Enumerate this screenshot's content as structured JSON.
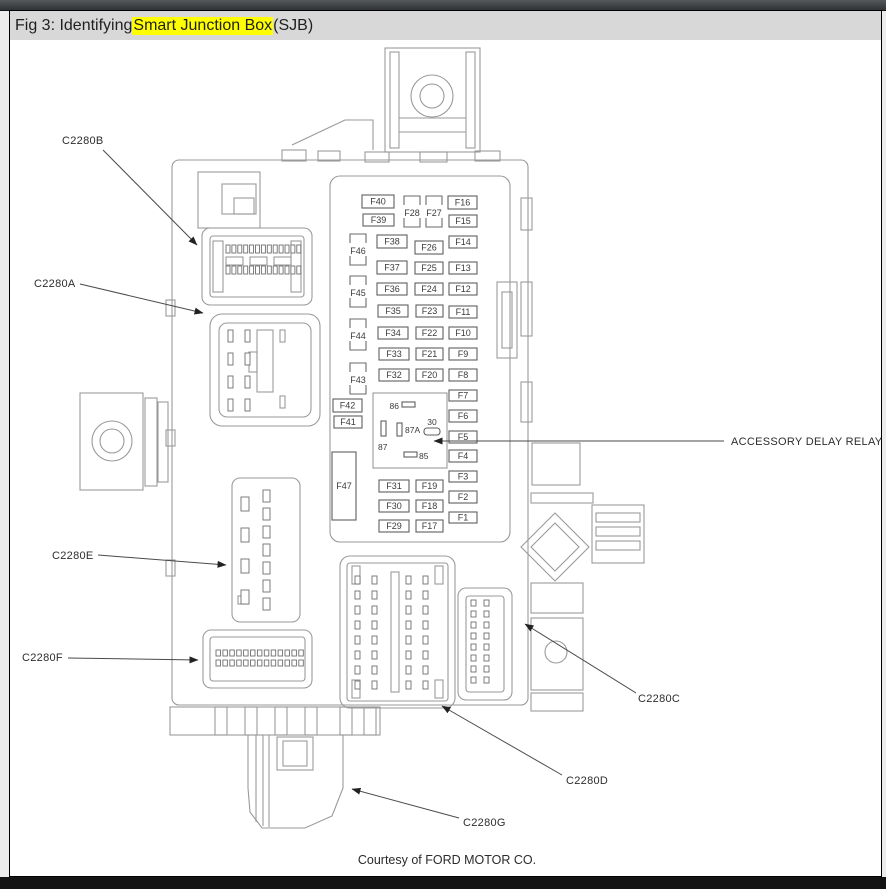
{
  "window": {
    "title_prefix": "Fig 3: Identifying ",
    "title_highlight": "Smart Junction Box",
    "title_suffix": " (SJB)",
    "highlight_color": "#ffff00"
  },
  "footer": {
    "courtesy": "Courtesy of FORD MOTOR CO."
  },
  "diagram": {
    "subject": "Smart Junction Box (SJB) fuse panel",
    "callouts": [
      {
        "id": "c2280b",
        "text": "C2280B",
        "tx": 62,
        "ty": 144,
        "x1": 103,
        "y1": 150,
        "x2": 197,
        "y2": 245
      },
      {
        "id": "c2280a",
        "text": "C2280A",
        "tx": 34,
        "ty": 287,
        "x1": 80,
        "y1": 284,
        "x2": 203,
        "y2": 313
      },
      {
        "id": "c2280e",
        "text": "C2280E",
        "tx": 52,
        "ty": 559,
        "x1": 98,
        "y1": 555,
        "x2": 226,
        "y2": 565
      },
      {
        "id": "c2280f",
        "text": "C2280F",
        "tx": 22,
        "ty": 661,
        "x1": 68,
        "y1": 658,
        "x2": 198,
        "y2": 660
      },
      {
        "id": "c2280c",
        "text": "C2280C",
        "tx": 638,
        "ty": 702,
        "x1": 636,
        "y1": 693,
        "x2": 525,
        "y2": 624
      },
      {
        "id": "c2280d",
        "text": "C2280D",
        "tx": 566,
        "ty": 784,
        "x1": 562,
        "y1": 775,
        "x2": 442,
        "y2": 706
      },
      {
        "id": "c2280g",
        "text": "C2280G",
        "tx": 463,
        "ty": 826,
        "x1": 459,
        "y1": 818,
        "x2": 352,
        "y2": 789
      },
      {
        "id": "accessory-delay-relay",
        "text": "ACCESSORY DELAY RELAY",
        "tx": 731,
        "ty": 445,
        "x1": 724,
        "y1": 441,
        "x2": 434,
        "y2": 441
      }
    ],
    "fuses": [
      {
        "l": "F40",
        "x": 362,
        "y": 195,
        "w": 32,
        "h": 13
      },
      {
        "l": "F39",
        "x": 363,
        "y": 214,
        "w": 31,
        "h": 12
      },
      {
        "l": "F38",
        "x": 377,
        "y": 235,
        "w": 30,
        "h": 13
      },
      {
        "l": "F37",
        "x": 377,
        "y": 261,
        "w": 30,
        "h": 13
      },
      {
        "l": "F36",
        "x": 377,
        "y": 283,
        "w": 30,
        "h": 12
      },
      {
        "l": "F35",
        "x": 378,
        "y": 305,
        "w": 30,
        "h": 12
      },
      {
        "l": "F34",
        "x": 378,
        "y": 327,
        "w": 30,
        "h": 12
      },
      {
        "l": "F33",
        "x": 379,
        "y": 348,
        "w": 30,
        "h": 12
      },
      {
        "l": "F32",
        "x": 379,
        "y": 369,
        "w": 30,
        "h": 12
      },
      {
        "l": "F31",
        "x": 379,
        "y": 480,
        "w": 30,
        "h": 12
      },
      {
        "l": "F30",
        "x": 379,
        "y": 500,
        "w": 30,
        "h": 12
      },
      {
        "l": "F29",
        "x": 379,
        "y": 520,
        "w": 30,
        "h": 12
      },
      {
        "l": "F26",
        "x": 415,
        "y": 241,
        "w": 28,
        "h": 13
      },
      {
        "l": "F25",
        "x": 415,
        "y": 262,
        "w": 28,
        "h": 12
      },
      {
        "l": "F24",
        "x": 415,
        "y": 283,
        "w": 28,
        "h": 12
      },
      {
        "l": "F23",
        "x": 416,
        "y": 305,
        "w": 27,
        "h": 12
      },
      {
        "l": "F22",
        "x": 416,
        "y": 327,
        "w": 27,
        "h": 12
      },
      {
        "l": "F21",
        "x": 416,
        "y": 348,
        "w": 27,
        "h": 12
      },
      {
        "l": "F20",
        "x": 416,
        "y": 369,
        "w": 27,
        "h": 12
      },
      {
        "l": "F19",
        "x": 416,
        "y": 480,
        "w": 27,
        "h": 12
      },
      {
        "l": "F18",
        "x": 416,
        "y": 500,
        "w": 27,
        "h": 12
      },
      {
        "l": "F17",
        "x": 416,
        "y": 520,
        "w": 27,
        "h": 12
      },
      {
        "l": "F16",
        "x": 448,
        "y": 196,
        "w": 29,
        "h": 13
      },
      {
        "l": "F15",
        "x": 449,
        "y": 215,
        "w": 28,
        "h": 12
      },
      {
        "l": "F14",
        "x": 449,
        "y": 236,
        "w": 28,
        "h": 12
      },
      {
        "l": "F13",
        "x": 449,
        "y": 262,
        "w": 28,
        "h": 12
      },
      {
        "l": "F12",
        "x": 449,
        "y": 283,
        "w": 28,
        "h": 12
      },
      {
        "l": "F11",
        "x": 449,
        "y": 306,
        "w": 28,
        "h": 12
      },
      {
        "l": "F10",
        "x": 449,
        "y": 327,
        "w": 28,
        "h": 12
      },
      {
        "l": "F9",
        "x": 449,
        "y": 348,
        "w": 28,
        "h": 12
      },
      {
        "l": "F8",
        "x": 449,
        "y": 369,
        "w": 28,
        "h": 12
      },
      {
        "l": "F7",
        "x": 449,
        "y": 390,
        "w": 28,
        "h": 11
      },
      {
        "l": "F6",
        "x": 449,
        "y": 410,
        "w": 28,
        "h": 12
      },
      {
        "l": "F5",
        "x": 449,
        "y": 431,
        "w": 28,
        "h": 12
      },
      {
        "l": "F4",
        "x": 449,
        "y": 450,
        "w": 28,
        "h": 12
      },
      {
        "l": "F3",
        "x": 449,
        "y": 471,
        "w": 28,
        "h": 11
      },
      {
        "l": "F2",
        "x": 449,
        "y": 491,
        "w": 28,
        "h": 12
      },
      {
        "l": "F1",
        "x": 449,
        "y": 512,
        "w": 28,
        "h": 11
      },
      {
        "l": "F42",
        "x": 333,
        "y": 399,
        "w": 29,
        "h": 13
      },
      {
        "l": "F41",
        "x": 334,
        "y": 416,
        "w": 28,
        "h": 12
      },
      {
        "l": "F47",
        "x": 332,
        "y": 452,
        "w": 24,
        "h": 68
      }
    ],
    "bracket_fuses": [
      {
        "l": "F46",
        "cx": 358,
        "cy": 251
      },
      {
        "l": "F45",
        "cx": 358,
        "cy": 293
      },
      {
        "l": "F44",
        "cx": 358,
        "cy": 336
      },
      {
        "l": "F43",
        "cx": 358,
        "cy": 380
      },
      {
        "l": "F28",
        "cx": 412,
        "cy": 213
      },
      {
        "l": "F27",
        "cx": 434,
        "cy": 213
      }
    ],
    "relay_pins": [
      {
        "t": "86",
        "tx": 399,
        "ty": 409,
        "anchor": "end"
      },
      {
        "t": "87",
        "tx": 378,
        "ty": 450,
        "anchor": "start"
      },
      {
        "t": "87A",
        "tx": 405,
        "ty": 433,
        "anchor": "start"
      },
      {
        "t": "30",
        "tx": 432,
        "ty": 425,
        "anchor": "middle"
      },
      {
        "t": "85",
        "tx": 419,
        "ty": 459,
        "anchor": "start"
      }
    ]
  }
}
